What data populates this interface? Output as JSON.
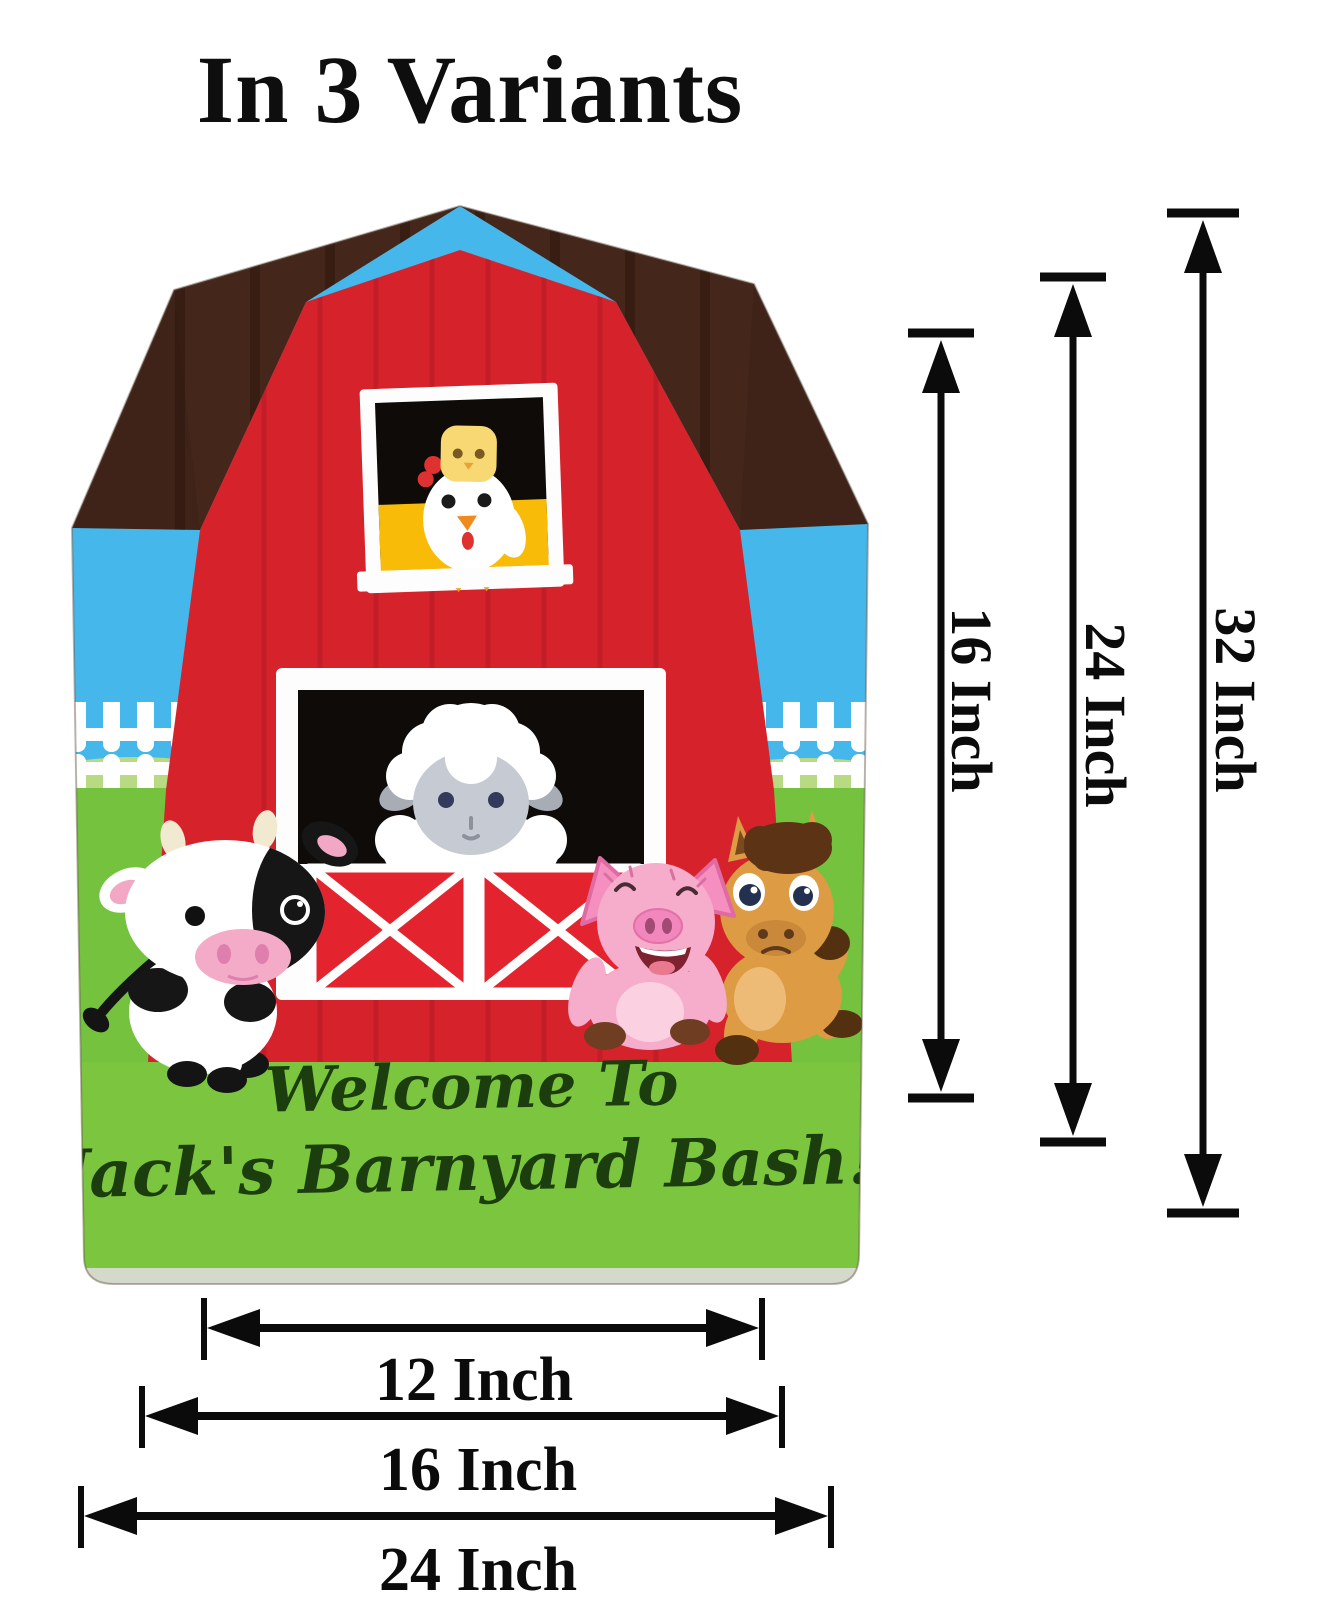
{
  "title": "In 3 Variants",
  "sign": {
    "welcome_line1": "Welcome To",
    "welcome_line2": "Jack's Barnyard Bash!",
    "animals": [
      "chicken",
      "chick",
      "sheep",
      "cow",
      "pig",
      "horse"
    ],
    "scene": [
      "barn",
      "roof",
      "sky",
      "hills",
      "fence",
      "grass"
    ]
  },
  "dimensions": {
    "unit": "Inch",
    "heights": [
      {
        "label": "16 Inch"
      },
      {
        "label": "24 Inch"
      },
      {
        "label": "32 Inch"
      }
    ],
    "widths": [
      {
        "label": "12 Inch"
      },
      {
        "label": "16 Inch"
      },
      {
        "label": "24 Inch"
      }
    ]
  },
  "colors": {
    "barn_red": "#d6232b",
    "door_red": "#e3242f",
    "roof_brown": "#3f2318",
    "sky_blue": "#45b7ea",
    "hill_green": "#b7da83",
    "grass_green": "#74c23d",
    "fence_white": "#ffffff",
    "script_green": "#1c3e0e",
    "dimension_black": "#0b0b0b"
  }
}
